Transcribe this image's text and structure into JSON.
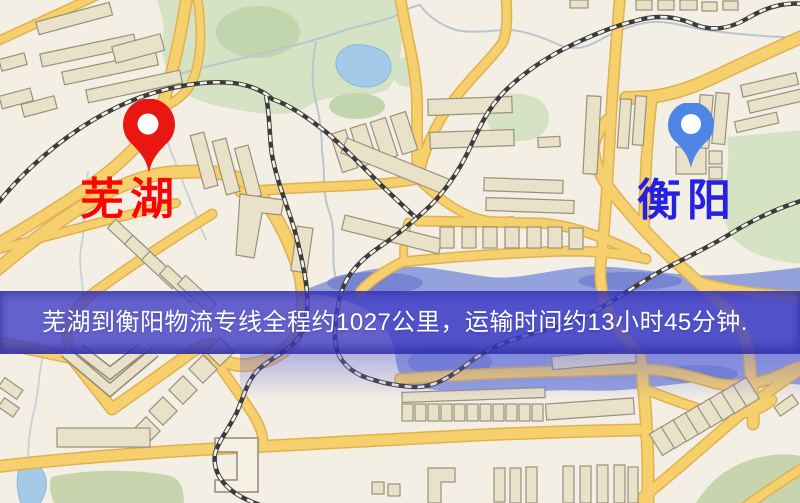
{
  "page": {
    "type": "logistics-route-map-screenshot"
  },
  "banner": {
    "text": "芜湖到衡阳物流专线全程约1027公里，运输时间约13小时45分钟."
  },
  "markers": {
    "origin": {
      "label": "芜湖",
      "pin_icon": "red-map-pin-icon"
    },
    "destination": {
      "label": "衡阳",
      "pin_icon": "blue-map-pin-icon"
    }
  },
  "palette": {
    "banner_bg": "rgba(64,61,198,0.8)",
    "banner_text": "#ffffff",
    "origin_pin": "#ea1612",
    "origin_label": "#fb0503",
    "destination_pin": "#4f86e6",
    "destination_label": "#2521e2",
    "map_background": "#f3efe4",
    "road_fill": "#f6d06d",
    "road_casing": "#e2b050",
    "building": "#eae2c8",
    "park_green": "#d5e3c4",
    "lake_water": "#a3cbe8",
    "river_water": "#94a2dc",
    "railway": "#3b3b3b"
  }
}
